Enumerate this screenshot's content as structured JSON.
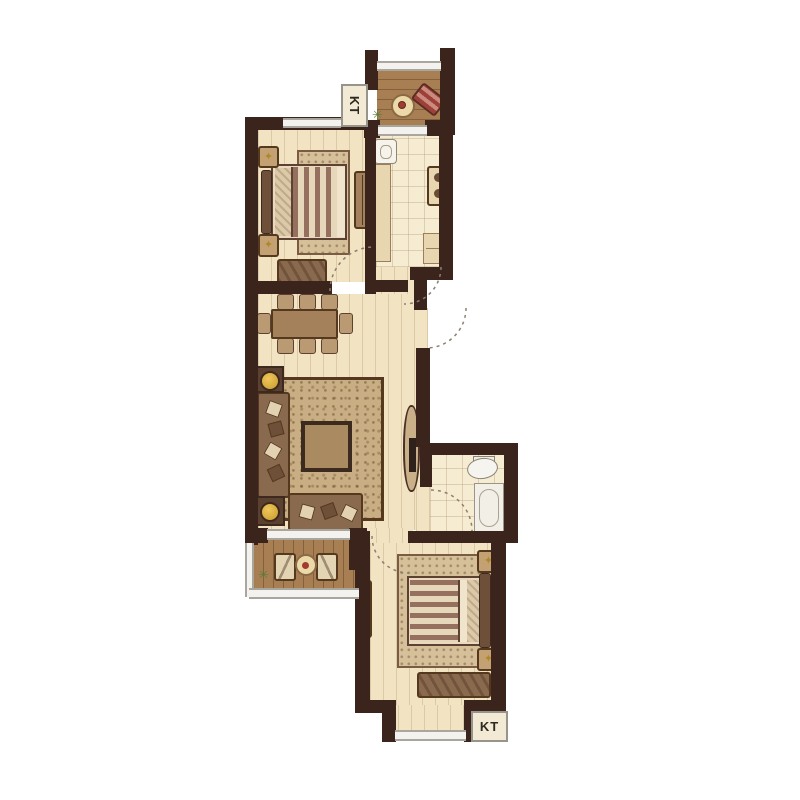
{
  "labels": {
    "kt_north": "KT",
    "kt_south": "KT"
  },
  "icons": {
    "star": "✦",
    "plant": "✳"
  },
  "colors": {
    "wall": "#3a241c",
    "floor_cream": "#f2e4c2",
    "tile": "#f6ecd2",
    "balcony_wood": "#a87e53",
    "window_gray": "#a9a69e",
    "rug": "#c9ae84",
    "lamp_yellow": "#e0b03c",
    "lounge_chair_red": "#9e4038",
    "furniture_wood": "#8a6a4e",
    "bed_stripe": "#96705f"
  }
}
